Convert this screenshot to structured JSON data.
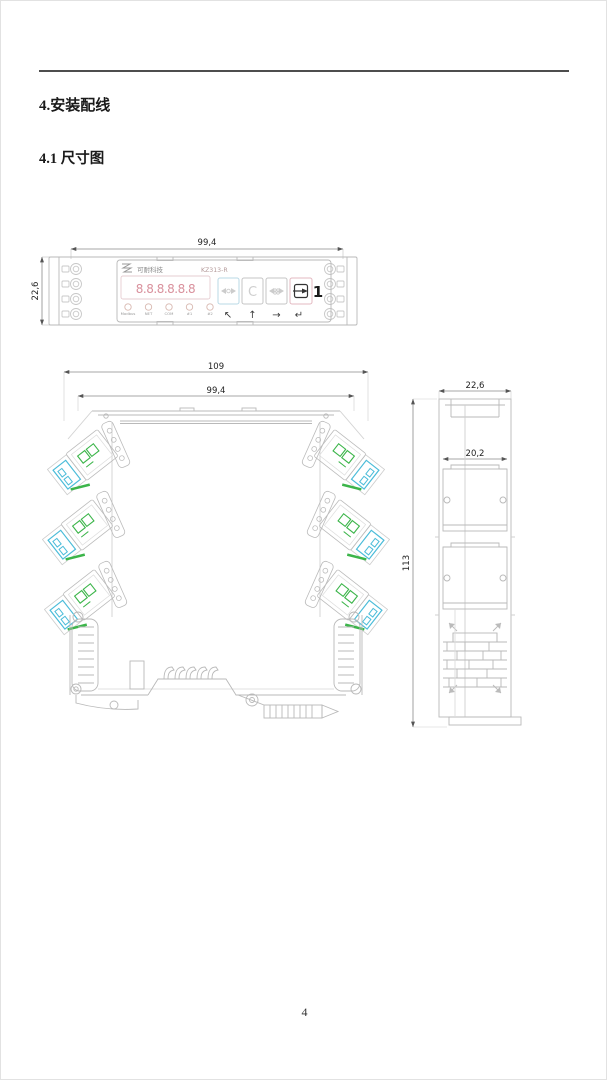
{
  "document": {
    "section_heading": "4.安装配线",
    "subsection_heading": "4.1 尺寸图",
    "page_number": "4"
  },
  "top_view": {
    "dim_width": "99,4",
    "dim_depth": "22,6",
    "brand": "可耐科技",
    "model": "KZ313-R",
    "display_value": "8.8.8.8.8.8",
    "led_labels": [
      "Modbus",
      "NET",
      "COM",
      "#1",
      "#2"
    ],
    "button_c_label": "C",
    "button_one_label": "1",
    "nav_arrows": [
      "↖",
      "↑",
      "→",
      "↵"
    ]
  },
  "front_view": {
    "dim_overall_width": "109",
    "dim_body_width": "99,4"
  },
  "side_view": {
    "dim_depth": "22,6",
    "dim_inner_depth": "20,2",
    "dim_height": "113"
  },
  "colors": {
    "terminal_cyan": "#4bbcd9",
    "terminal_green": "#3cb54a",
    "drawing_line": "#b9b9b9",
    "display_segment": "#d9919d",
    "rule_gray": "#4d4d4d"
  }
}
